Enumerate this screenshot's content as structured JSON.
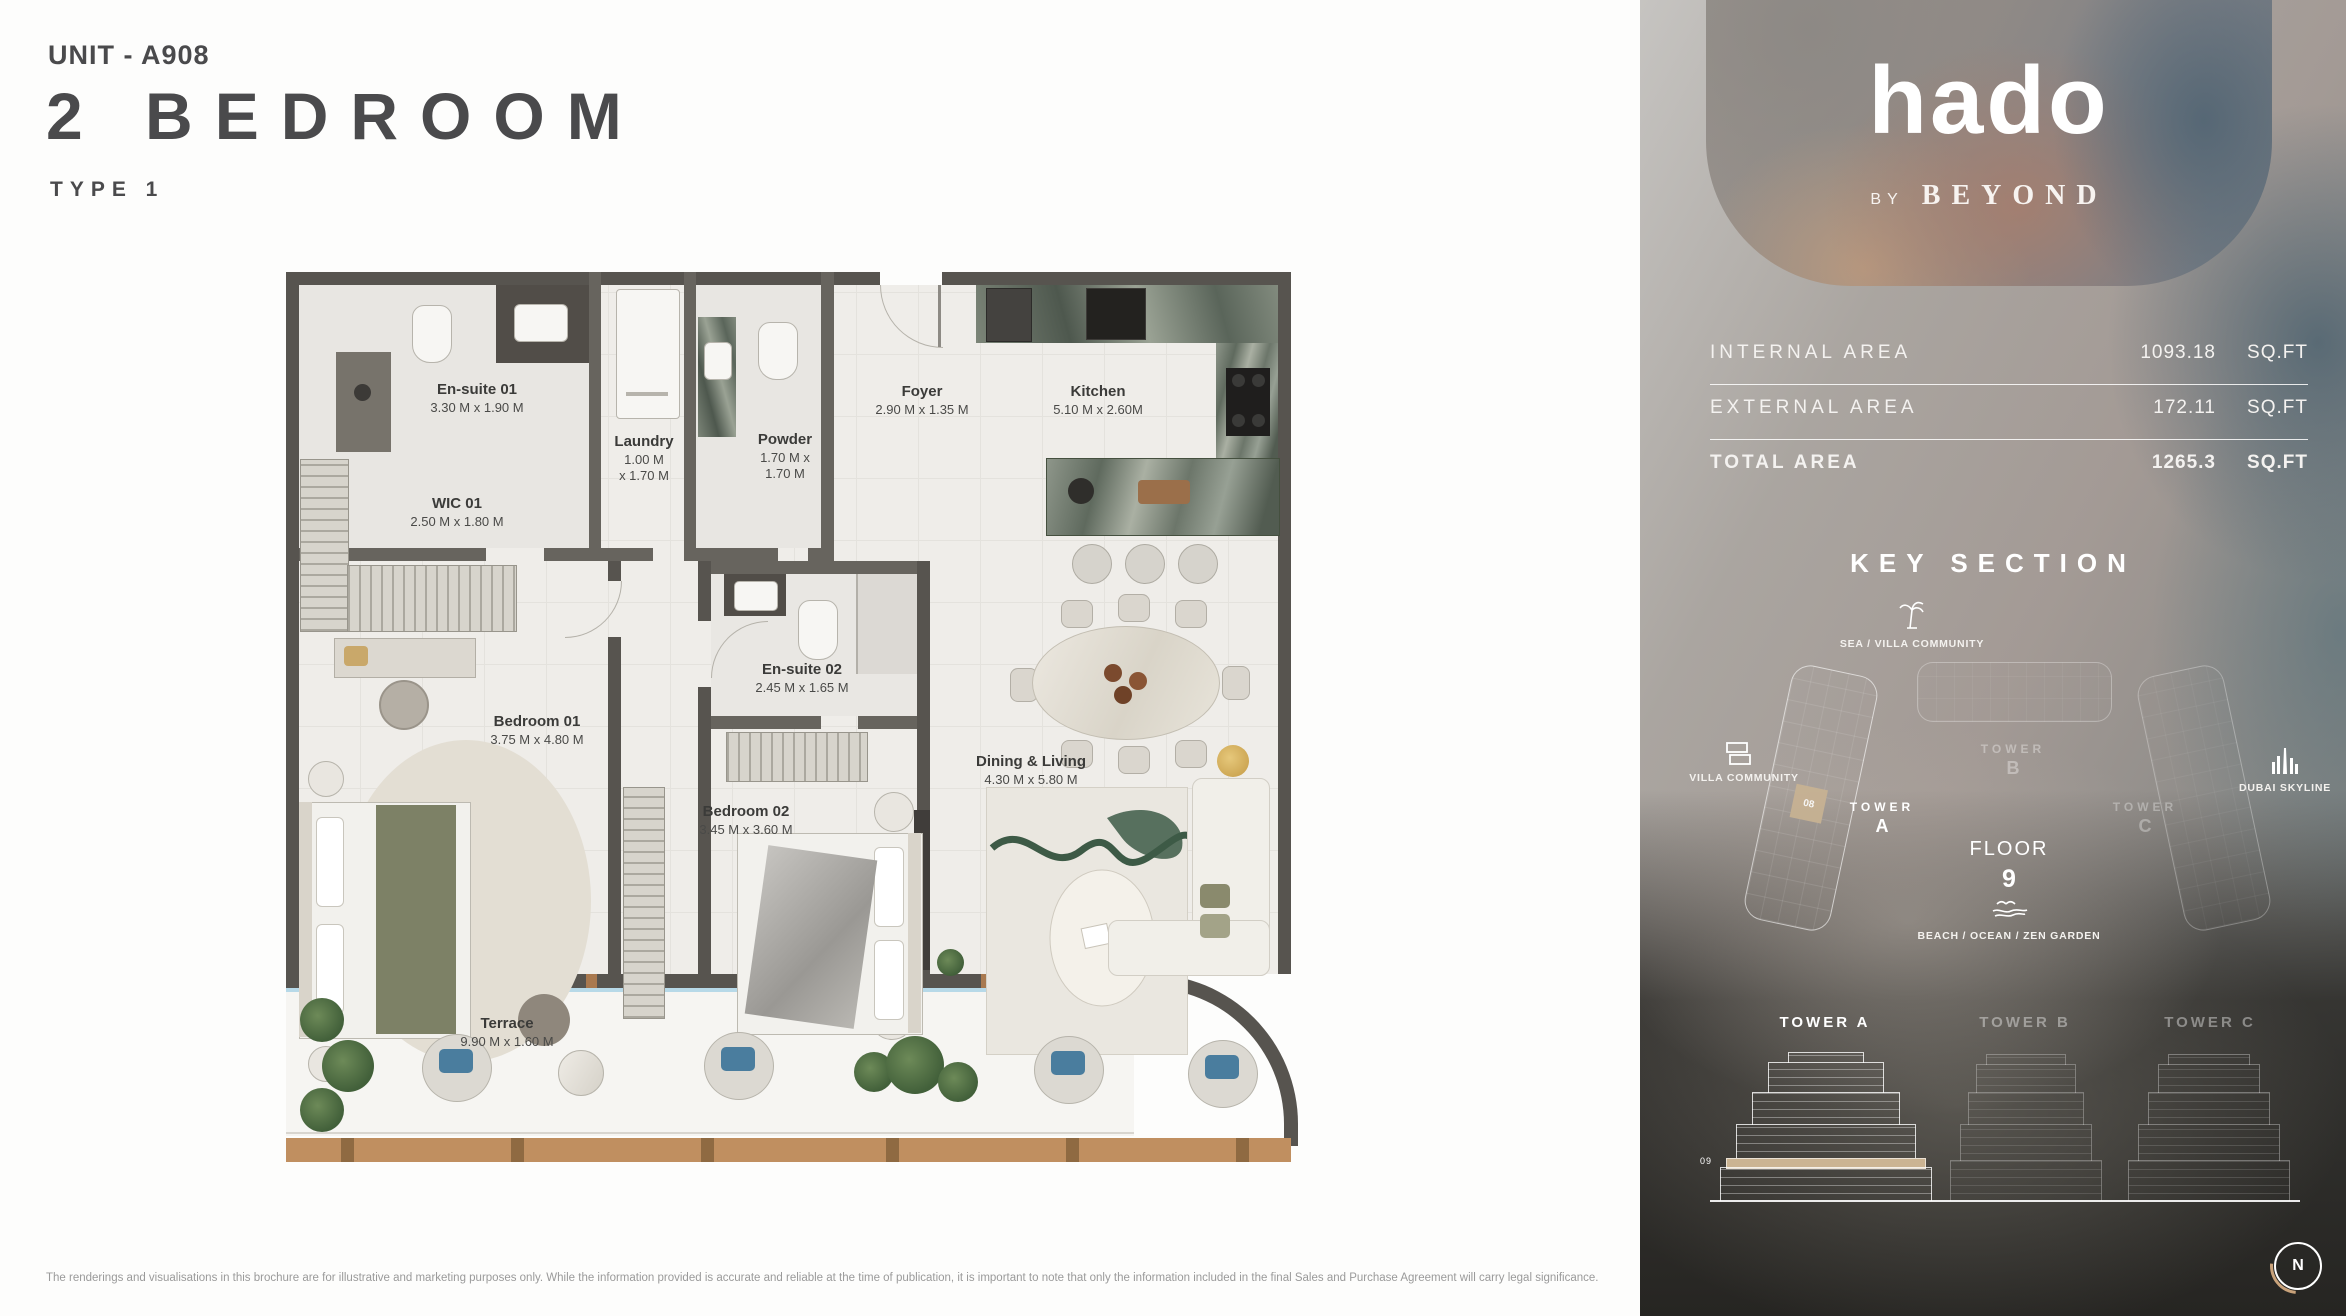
{
  "header": {
    "unit": "UNIT - A908",
    "title": "2 BEDROOM",
    "type": "TYPE 1"
  },
  "rooms": [
    {
      "name": "En-suite 01",
      "dims": "3.30 M x 1.90 M"
    },
    {
      "name": "Laundry",
      "dims": "1.00 M",
      "dims2": "x 1.70 M"
    },
    {
      "name": "Powder",
      "dims": "1.70 M x",
      "dims2": "1.70 M"
    },
    {
      "name": "Foyer",
      "dims": "2.90 M x 1.35 M"
    },
    {
      "name": "Kitchen",
      "dims": "5.10 M x 2.60M"
    },
    {
      "name": "WIC 01",
      "dims": "2.50 M x 1.80 M"
    },
    {
      "name": "Bedroom 01",
      "dims": "3.75 M x 4.80 M"
    },
    {
      "name": "En-suite 02",
      "dims": "2.45 M x 1.65 M"
    },
    {
      "name": "Bedroom 02",
      "dims": "3.45 M x 3.60 M"
    },
    {
      "name": "Dining & Living",
      "dims": "4.30 M x 5.80 M"
    },
    {
      "name": "Terrace",
      "dims": "9.90 M x 1.60 M"
    }
  ],
  "brand": {
    "logo": "hado",
    "by": "BY",
    "name": "BEYOND"
  },
  "areas": {
    "rows": [
      {
        "label": "INTERNAL AREA",
        "value": "1093.18",
        "unit": "SQ.FT"
      },
      {
        "label": "EXTERNAL AREA",
        "value": "172.11",
        "unit": "SQ.FT"
      },
      {
        "label": "TOTAL AREA",
        "value": "1265.3",
        "unit": "SQ.FT"
      }
    ]
  },
  "key_section": {
    "heading": "KEY SECTION",
    "sea": "SEA / VILLA COMMUNITY",
    "villa": "VILLA COMMUNITY",
    "dubai": "DUBAI SKYLINE",
    "beach": "BEACH / OCEAN / ZEN GARDEN",
    "floor_word": "FLOOR",
    "floor_number": "9",
    "unit_marker": "08",
    "tower_a_word": "TOWER",
    "tower_a_letter": "A",
    "tower_b_word": "TOWER",
    "tower_b_letter": "B",
    "tower_c_word": "TOWER",
    "tower_c_letter": "C"
  },
  "elevations": {
    "tower_a": "TOWER A",
    "tower_b": "TOWER B",
    "tower_c": "TOWER C",
    "floor_marker": "09"
  },
  "compass": {
    "label": "N"
  },
  "disclaimer": "The renderings and visualisations in this brochure are for illustrative and marketing purposes only. While the information provided is accurate and reliable at the time of publication, it is important to note that only the information included in the final Sales and Purchase Agreement will carry legal significance."
}
